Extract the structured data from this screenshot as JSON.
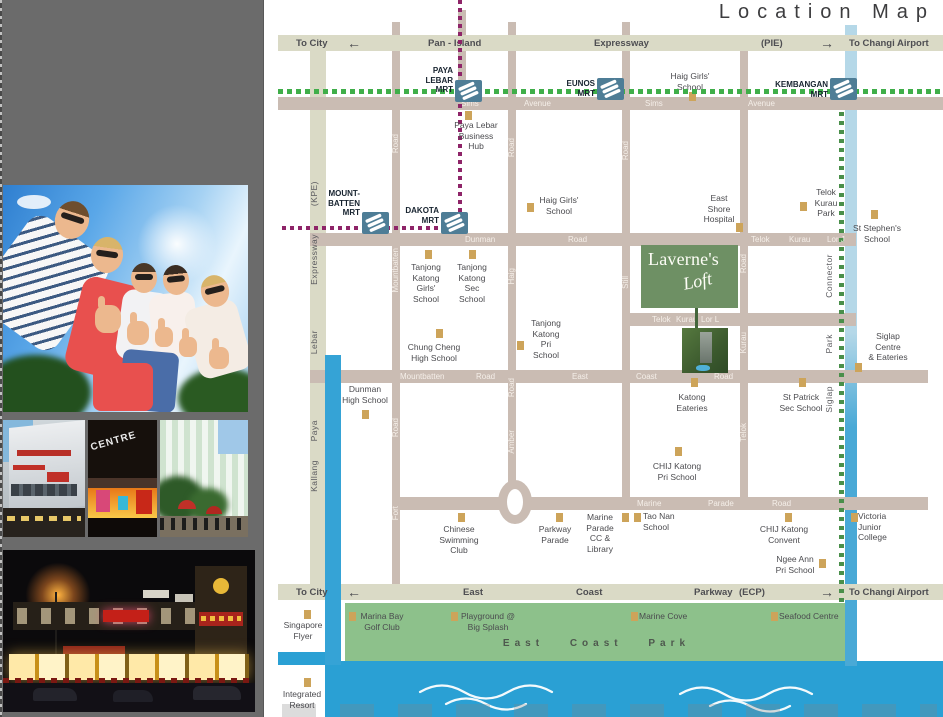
{
  "sidebar": {
    "centre_sign": "CENTRE"
  },
  "map": {
    "title": "Location Map",
    "icons": {
      "arrow_left": "←",
      "arrow_right": "→",
      "mrt_logo": "mrt-logo",
      "landmark_marker": "gold-square"
    },
    "colors": {
      "expressway": "#dadac6",
      "road": "#cabcb3",
      "park": "#8dc18b",
      "sea": "#2aa0d4",
      "canal": "#8fc6e0",
      "mrt_line_green": "#3fae49",
      "circle_line_purple": "#8e2468",
      "landmark": "#cda45a",
      "logo_green": "#6e9064",
      "mrt_icon": "#4e7d96",
      "sidebar": "#6b6b6b"
    },
    "logo": {
      "name": "Laverne's",
      "sub": "Loft"
    },
    "park_label": "East Coast Park",
    "exp_labels": [
      {
        "t": "To City",
        "x": 296,
        "y": 38
      },
      {
        "t": "Pan - Island",
        "x": 428,
        "y": 38
      },
      {
        "t": "Expressway",
        "x": 594,
        "y": 38
      },
      {
        "t": "(PIE)",
        "x": 761,
        "y": 38
      },
      {
        "t": "To Changi Airport",
        "x": 849,
        "y": 38
      },
      {
        "t": "To City",
        "x": 296,
        "y": 587
      },
      {
        "t": "East",
        "x": 463,
        "y": 587
      },
      {
        "t": "Coast",
        "x": 576,
        "y": 587
      },
      {
        "t": "Parkway",
        "x": 694,
        "y": 587
      },
      {
        "t": "(ECP)",
        "x": 739,
        "y": 587
      },
      {
        "t": "To Changi Airport",
        "x": 849,
        "y": 587
      }
    ],
    "arrows": [
      {
        "dir": "left",
        "x": 347,
        "y": 36
      },
      {
        "dir": "right",
        "x": 820,
        "y": 36
      },
      {
        "dir": "left",
        "x": 347,
        "y": 585
      },
      {
        "dir": "right",
        "x": 820,
        "y": 585
      }
    ],
    "road_labels": [
      {
        "t": "Sims",
        "x": 461,
        "y": 99
      },
      {
        "t": "Avenue",
        "x": 524,
        "y": 99
      },
      {
        "t": "Sims",
        "x": 645,
        "y": 99
      },
      {
        "t": "Avenue",
        "x": 748,
        "y": 99
      },
      {
        "t": "Dunman",
        "x": 465,
        "y": 235
      },
      {
        "t": "Road",
        "x": 568,
        "y": 235
      },
      {
        "t": "Telok",
        "x": 751,
        "y": 235
      },
      {
        "t": "Kurau",
        "x": 789,
        "y": 235
      },
      {
        "t": "Lor J",
        "x": 827,
        "y": 235
      },
      {
        "t": "Telok",
        "x": 652,
        "y": 315
      },
      {
        "t": "Kurau",
        "x": 676,
        "y": 315
      },
      {
        "t": "Lor L",
        "x": 701,
        "y": 315
      },
      {
        "t": "Mountbatten",
        "x": 400,
        "y": 372
      },
      {
        "t": "Road",
        "x": 476,
        "y": 372
      },
      {
        "t": "East",
        "x": 572,
        "y": 372
      },
      {
        "t": "Coast",
        "x": 636,
        "y": 372
      },
      {
        "t": "Road",
        "x": 714,
        "y": 372
      },
      {
        "t": "Marine",
        "x": 637,
        "y": 499
      },
      {
        "t": "Parade",
        "x": 708,
        "y": 499
      },
      {
        "t": "Road",
        "x": 772,
        "y": 499
      }
    ],
    "vroad_labels": [
      {
        "t": "(KPE)",
        "x": 309,
        "y": 181,
        "c": "g"
      },
      {
        "t": "Expressway",
        "x": 309,
        "y": 234,
        "c": "g"
      },
      {
        "t": "Lebar",
        "x": 309,
        "y": 330,
        "c": "g"
      },
      {
        "t": "Paya",
        "x": 309,
        "y": 420,
        "c": "g"
      },
      {
        "t": "Kallang",
        "x": 309,
        "y": 460,
        "c": "g"
      },
      {
        "t": "Road",
        "x": 391,
        "y": 134,
        "c": "w"
      },
      {
        "t": "Mountbatten",
        "x": 391,
        "y": 248,
        "c": "w"
      },
      {
        "t": "Road",
        "x": 391,
        "y": 418,
        "c": "w"
      },
      {
        "t": "Fort",
        "x": 391,
        "y": 506,
        "c": "w"
      },
      {
        "t": "Road",
        "x": 507,
        "y": 138,
        "c": "w"
      },
      {
        "t": "Haig",
        "x": 507,
        "y": 268,
        "c": "w"
      },
      {
        "t": "Road",
        "x": 507,
        "y": 378,
        "c": "w"
      },
      {
        "t": "Amber",
        "x": 507,
        "y": 430,
        "c": "w"
      },
      {
        "t": "Road",
        "x": 621,
        "y": 141,
        "c": "w"
      },
      {
        "t": "Still",
        "x": 621,
        "y": 276,
        "c": "w"
      },
      {
        "t": "Road",
        "x": 739,
        "y": 254,
        "c": "w"
      },
      {
        "t": "Kurau",
        "x": 739,
        "y": 332,
        "c": "w"
      },
      {
        "t": "Telok",
        "x": 739,
        "y": 423,
        "c": "w"
      },
      {
        "t": "Connector",
        "x": 824,
        "y": 254,
        "c": "g"
      },
      {
        "t": "Park",
        "x": 824,
        "y": 334,
        "c": "g"
      },
      {
        "t": "Siglap",
        "x": 824,
        "y": 386,
        "c": "g"
      }
    ],
    "mrt_stations": [
      {
        "n": "paya-lebar-mrt",
        "label": "PAYA\nLEBAR\nMRT",
        "icon": [
          455,
          80
        ],
        "tx": 405,
        "ty": 66,
        "tw": 48
      },
      {
        "n": "eunos-mrt",
        "label": "EUNOS\nMRT",
        "icon": [
          597,
          78
        ],
        "tx": 548,
        "ty": 79,
        "tw": 47
      },
      {
        "n": "kembangan-mrt",
        "label": "KEMBANGAN\nMRT",
        "icon": [
          830,
          78
        ],
        "tx": 767,
        "ty": 80,
        "tw": 61
      },
      {
        "n": "mountbatten-mrt",
        "label": "MOUNT-\nBATTEN\nMRT",
        "icon": [
          362,
          212
        ],
        "tx": 315,
        "ty": 189,
        "tw": 45
      },
      {
        "n": "dakota-mrt",
        "label": "DAKOTA\nMRT",
        "icon": [
          441,
          212
        ],
        "tx": 394,
        "ty": 206,
        "tw": 45
      }
    ],
    "landmarks": [
      {
        "n": "haig-girls-school-north",
        "text": "Haig Girls'\nSchool",
        "sq": [
          689,
          92
        ],
        "tx": 664,
        "ty": 71,
        "tw": 52,
        "al": "c"
      },
      {
        "n": "paya-lebar-business-hub",
        "text": "Paya Lebar\nBusiness\nHub",
        "sq": [
          465,
          111
        ],
        "tx": 447,
        "ty": 120,
        "tw": 58,
        "al": "c"
      },
      {
        "n": "haig-girls-school",
        "text": "Haig Girls'\nSchool",
        "sq": [
          527,
          203
        ],
        "tx": 536,
        "ty": 195,
        "tw": 46,
        "al": "c"
      },
      {
        "n": "east-shore-hospital",
        "text": "East\nShore\nHospital",
        "sq": [
          736,
          223
        ],
        "tx": 698,
        "ty": 193,
        "tw": 42,
        "al": "c"
      },
      {
        "n": "telok-kurau-park",
        "text": "Telok\nKurau\nPark",
        "sq": [
          800,
          202
        ],
        "tx": 808,
        "ty": 187,
        "tw": 36,
        "al": "c"
      },
      {
        "n": "st-stephens-school",
        "text": "St Stephen's\nSchool",
        "sq": [
          871,
          210
        ],
        "tx": 845,
        "ty": 223,
        "tw": 64,
        "al": "c"
      },
      {
        "n": "tanjong-katong-girls-school",
        "text": "Tanjong\nKatong\nGirls'\nSchool",
        "sq": [
          425,
          250
        ],
        "tx": 402,
        "ty": 262,
        "tw": 48,
        "al": "c"
      },
      {
        "n": "tanjong-katong-sec-school",
        "text": "Tanjong\nKatong\nSec\nSchool",
        "sq": [
          469,
          250
        ],
        "tx": 450,
        "ty": 262,
        "tw": 44,
        "al": "c"
      },
      {
        "n": "chung-cheng-high-school",
        "text": "Chung Cheng\nHigh School",
        "sq": [
          436,
          329
        ],
        "tx": 402,
        "ty": 342,
        "tw": 64,
        "al": "c"
      },
      {
        "n": "tanjong-katong-pri-school",
        "text": "Tanjong\nKatong\nPri\nSchool",
        "sq": [
          517,
          341
        ],
        "tx": 524,
        "ty": 318,
        "tw": 44,
        "al": "c"
      },
      {
        "n": "dunman-high-school",
        "text": "Dunman\nHigh School",
        "sq": [
          362,
          410
        ],
        "tx": 337,
        "ty": 384,
        "tw": 56,
        "al": "c"
      },
      {
        "n": "katong-eateries",
        "text": "Katong\nEateries",
        "sq": [
          691,
          378
        ],
        "tx": 666,
        "ty": 392,
        "tw": 52,
        "al": "c"
      },
      {
        "n": "st-patrick-sec-school",
        "text": "St Patrick\nSec School",
        "sq": [
          799,
          378
        ],
        "tx": 772,
        "ty": 392,
        "tw": 58,
        "al": "c"
      },
      {
        "n": "chij-katong-pri-school",
        "text": "CHIJ Katong\nPri School",
        "sq": [
          675,
          447
        ],
        "tx": 647,
        "ty": 461,
        "tw": 60,
        "al": "c"
      },
      {
        "n": "marine-parade-cc-library",
        "text": "Marine\nParade\nCC &\nLibrary",
        "sq": [
          622,
          513
        ],
        "tx": 578,
        "ty": 512,
        "tw": 44,
        "al": "c"
      },
      {
        "n": "tao-nan-school",
        "text": "Tao Nan\nSchool",
        "sq": [
          634,
          513
        ],
        "tx": 643,
        "ty": 511,
        "tw": 40,
        "al": "l"
      },
      {
        "n": "chinese-swimming-club",
        "text": "Chinese\nSwimming\nClub",
        "sq": [
          458,
          513
        ],
        "tx": 432,
        "ty": 524,
        "tw": 54,
        "al": "c"
      },
      {
        "n": "parkway-parade",
        "text": "Parkway\nParade",
        "sq": [
          556,
          513
        ],
        "tx": 531,
        "ty": 524,
        "tw": 48,
        "al": "c"
      },
      {
        "n": "chij-katong-convent",
        "text": "CHIJ Katong\nConvent",
        "sq": [
          785,
          513
        ],
        "tx": 755,
        "ty": 524,
        "tw": 58,
        "al": "c"
      },
      {
        "n": "ngee-ann-pri-school",
        "text": "Ngee Ann\nPri School",
        "sq": [
          819,
          559
        ],
        "tx": 772,
        "ty": 554,
        "tw": 46,
        "al": "c"
      },
      {
        "n": "victoria-junior-college",
        "text": "Victoria\nJunior\nCollege",
        "sq": [
          851,
          513
        ],
        "tx": 858,
        "ty": 511,
        "tw": 40,
        "al": "l"
      },
      {
        "n": "siglap-centre-eateries",
        "text": "Siglap\nCentre\n& Eateries",
        "sq": [
          855,
          363
        ],
        "tx": 863,
        "ty": 331,
        "tw": 50,
        "al": "c"
      },
      {
        "n": "singapore-flyer",
        "text": "Singapore\nFlyer",
        "sq": [
          304,
          610
        ],
        "tx": 280,
        "ty": 620,
        "tw": 46,
        "al": "c"
      },
      {
        "n": "integrated-resort",
        "text": "Integrated\nResort",
        "sq": [
          304,
          678
        ],
        "tx": 278,
        "ty": 689,
        "tw": 48,
        "al": "c"
      },
      {
        "n": "marina-bay-golf-club",
        "text": "Marina Bay\nGolf Club",
        "sq": [
          349,
          612
        ],
        "tx": 356,
        "ty": 611,
        "tw": 52,
        "al": "c"
      },
      {
        "n": "playground-big-splash",
        "text": "Playground @\nBig Splash",
        "sq": [
          451,
          612
        ],
        "tx": 458,
        "ty": 611,
        "tw": 60,
        "al": "c"
      },
      {
        "n": "marine-cove",
        "text": "Marine Cove",
        "sq": [
          631,
          612
        ],
        "tx": 639,
        "ty": 611,
        "tw": 60,
        "al": "l"
      },
      {
        "n": "seafood-centre",
        "text": "Seafood Centre",
        "sq": [
          771,
          612
        ],
        "tx": 779,
        "ty": 611,
        "tw": 70,
        "al": "l"
      }
    ]
  }
}
